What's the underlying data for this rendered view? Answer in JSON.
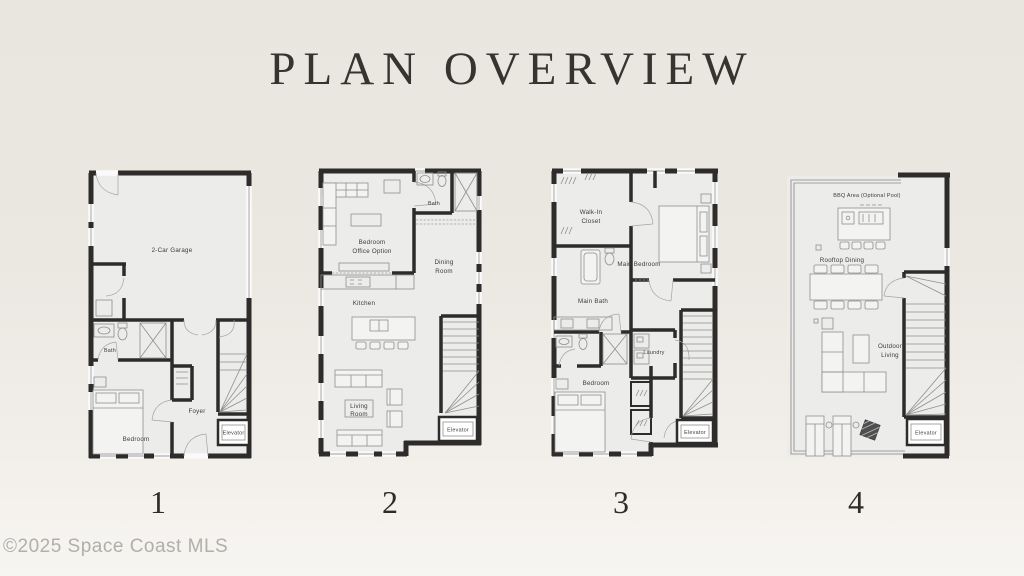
{
  "page": {
    "title": "PLAN OVERVIEW",
    "watermark": "©2025 Space Coast MLS"
  },
  "colors": {
    "background_top": "#e9e5df",
    "background_bottom": "#f7f5f2",
    "wall": "#2d2c2a",
    "floor": "#ececeb",
    "furniture_line": "#8f8f8f",
    "label_text": "#3b3b3b",
    "title_text": "#37332e",
    "watermark_text": "#b2afa9"
  },
  "plans": [
    {
      "number": "1",
      "labels": {
        "garage": "2-Car Garage",
        "bath": "Bath",
        "bedroom": "Bedroom",
        "foyer": "Foyer",
        "elevator": "Elevator"
      }
    },
    {
      "number": "2",
      "labels": {
        "bedroom_office": [
          "Bedroom",
          "Office Option"
        ],
        "bath": "Bath",
        "dining": [
          "Dining",
          "Room"
        ],
        "kitchen": "Kitchen",
        "living": [
          "Living",
          "Room"
        ],
        "elevator": "Elevator"
      }
    },
    {
      "number": "3",
      "labels": {
        "walk_in": [
          "Walk-In",
          "Closet"
        ],
        "main_bedroom": "Main Bedroom",
        "main_bath": "Main Bath",
        "laundry": "Laundry",
        "bedroom": "Bedroom",
        "elevator": "Elevator"
      }
    },
    {
      "number": "4",
      "labels": {
        "bbq": "BBQ Area (Optional Pool)",
        "rooftop": "Rooftop Dining",
        "outdoor": [
          "Outdoor",
          "Living"
        ],
        "elevator": "Elevator"
      }
    }
  ]
}
